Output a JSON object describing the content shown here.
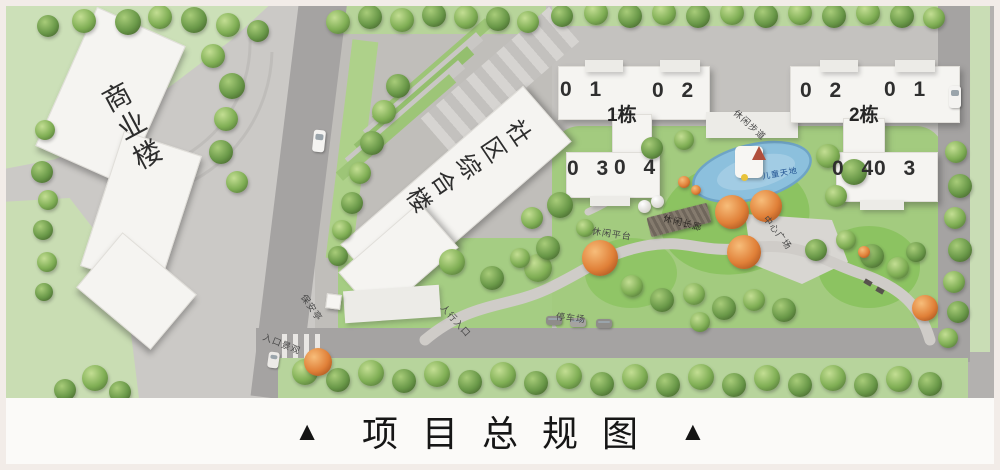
{
  "caption": {
    "marker_left": "▲",
    "marker_right": "▲",
    "title": "项目总规图"
  },
  "buildings": {
    "commercial": {
      "label": "商业楼"
    },
    "community": {
      "label": "社区综合楼"
    },
    "tower1": {
      "name": "1栋",
      "units": {
        "u01": "0 1",
        "u02": "0 2",
        "u03": "0 3",
        "u04": "0 4"
      }
    },
    "tower2": {
      "name": "2栋",
      "units": {
        "u02": "0 2",
        "u01": "0 1",
        "u04": "0 4",
        "u03": "0 3"
      }
    }
  },
  "site_labels": {
    "leisure_trail": "休闲步道",
    "children_area": "儿童天地",
    "leisure_corridor": "休闲长廊",
    "central_plaza": "中心广场",
    "leisure_platform": "休闲平台",
    "parking": "停车场",
    "security_booth": "保安亭",
    "entrance_landscape": "入口景观",
    "pedestrian_entrance": "人行入口"
  },
  "colors": {
    "road": "#a5a3a2",
    "pavement": "#c9c7c4",
    "lawn": "#cce0b8",
    "garden_green": "#a3cb7f",
    "building_white": "#f5f4f1",
    "pond_blue": "#8cc0dd",
    "orange_tree": "#e08038",
    "title_text": "#161616",
    "frame": "#f2ece8"
  }
}
